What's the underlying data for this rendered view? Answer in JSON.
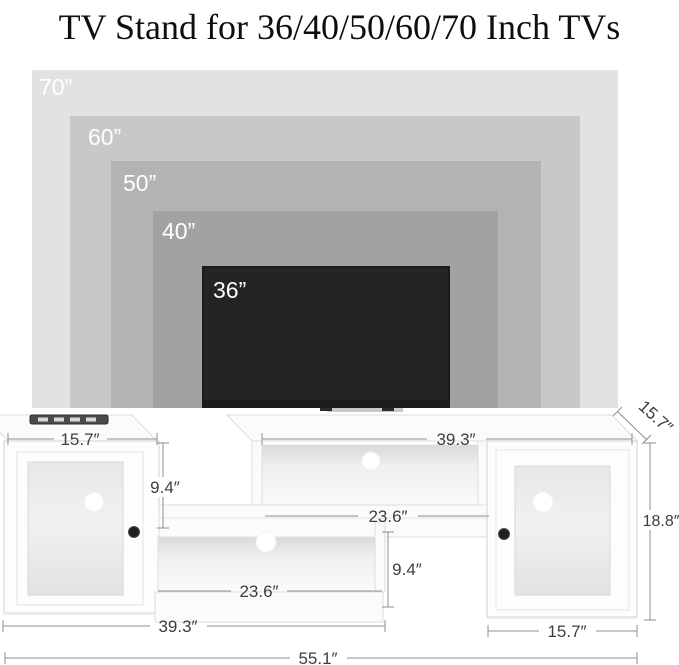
{
  "title": "TV Stand for 36/40/50/60/70 Inch TVs",
  "overlay": {
    "sizes": [
      {
        "label": "70”",
        "color": "#e2e2e4"
      },
      {
        "label": "60”",
        "color": "#c8c8ca"
      },
      {
        "label": "50”",
        "color": "#b3b3b5"
      },
      {
        "label": "40”",
        "color": "#a2a2a4"
      },
      {
        "label": "36”",
        "color": "#242427"
      }
    ]
  },
  "stand": {
    "dimensions": {
      "left_cabinet_top_width": "15.7″",
      "upper_shelf_length": "39.3″",
      "depth": "15.7″",
      "cabinet_height": "18.8″",
      "upper_opening_height": "9.4″",
      "upper_opening_width": "23.6″",
      "lower_opening_width": "23.6″",
      "lower_opening_height": "9.4″",
      "lower_shelf_length": "39.3″",
      "right_cabinet_bottom_width": "15.7″",
      "total_width": "55.1″"
    }
  },
  "colors": {
    "tv_screen": "#242427",
    "overlay_label_text": "#ffffff",
    "dimension_text": "#3e3e41",
    "dimension_line": "#8f8f93",
    "stand_body": "#fdfdfe",
    "background": "#ffffff"
  }
}
